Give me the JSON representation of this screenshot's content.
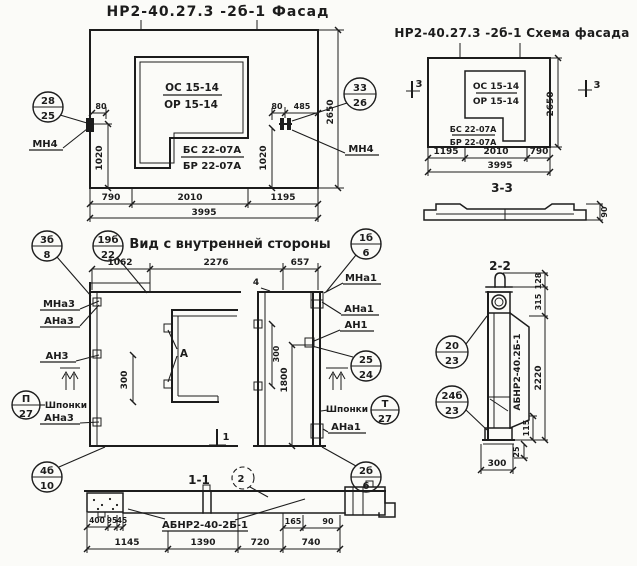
{
  "facade": {
    "title": "НР2-40.27.3 -2б-1 Фасад",
    "opening_mark_top": "ОС 15-14",
    "opening_mark_bottom": "ОР 15-14",
    "sill_mark_top": "БС 22-07А",
    "sill_mark_bottom": "БР 22-07А",
    "anchor_left_label": "МН4",
    "anchor_right_label": "МН4",
    "callout_left_top": "28",
    "callout_left_bottom": "25",
    "callout_right_top": "33",
    "callout_right_bottom": "26",
    "dim_left_offset": "80",
    "dim_left_height": "1020",
    "dim_right_offset": "80",
    "dim_right_edge": "485",
    "dim_right_height": "1020",
    "dim_height": "2650",
    "dim_bottom_1": "790",
    "dim_bottom_2": "2010",
    "dim_bottom_3": "1195",
    "dim_bottom_total": "3995"
  },
  "schema": {
    "title": "НР2-40.27.3 -2б-1 Схема фасада",
    "opening_mark_top": "ОС 15-14",
    "opening_mark_bottom": "ОР 15-14",
    "sill_mark_top": "БС 22-07А",
    "sill_mark_bottom": "БР 22-07А",
    "section_mark_left": "3",
    "section_mark_right": "3",
    "dim_height": "2650",
    "dim_bottom_1": "1195",
    "dim_bottom_2": "2010",
    "dim_bottom_3": "790",
    "dim_bottom_total": "3995",
    "profile_title": "3-3",
    "profile_dim": "90"
  },
  "inner": {
    "title": "Вид с внутренней стороны",
    "dim_top_1": "1062",
    "dim_top_2": "2276",
    "dim_top_3": "657",
    "dim_height": "1800",
    "dim_left_keys": "300",
    "dim_right_keys": "300",
    "detail_letter": "А",
    "node_mark_top": "4",
    "section_mark_bottom": "1",
    "label_mna3": "МНа3",
    "label_ana3_top": "АНа3",
    "label_an3": "АН3",
    "label_keys_left": "Шпонки",
    "label_ana3_bottom": "АНа3",
    "label_mna1": "МНа1",
    "label_ana1_top": "АНа1",
    "label_an1": "АН1",
    "label_keys_right": "Шпонки",
    "label_ana1_bottom": "АНа1",
    "callout_3b_top": "3б",
    "callout_3b_bottom": "8",
    "callout_19b_top": "19б",
    "callout_19b_bottom": "22",
    "callout_1b_top": "1б",
    "callout_1b_bottom": "6",
    "callout_p_top": "П",
    "callout_p_bottom": "27",
    "callout_25_top": "25",
    "callout_25_bottom": "24",
    "callout_t_top": "Т",
    "callout_t_bottom": "27",
    "callout_2b_top": "2б",
    "callout_2b_bottom": "6",
    "callout_4b_top": "4б",
    "callout_4b_bottom": "10"
  },
  "section11": {
    "title": "1-1",
    "detail_mark": "2",
    "part_label": "АБНР2-40-2Б-1",
    "dim_400": "400",
    "dim_95": "95",
    "dim_45": "45",
    "dim_1145": "1145",
    "dim_1390": "1390",
    "dim_720": "720",
    "dim_740": "740",
    "dim_165": "165",
    "dim_90": "90"
  },
  "section22": {
    "title": "2-2",
    "part_label": "АБНР2-40.2Б-1",
    "callout_20_top": "20",
    "callout_20_bottom": "23",
    "callout_24b_top": "24б",
    "callout_24b_bottom": "23",
    "dim_128": "128",
    "dim_315": "315",
    "dim_2220": "2220",
    "dim_115": "115",
    "dim_25": "25",
    "dim_300": "300"
  }
}
